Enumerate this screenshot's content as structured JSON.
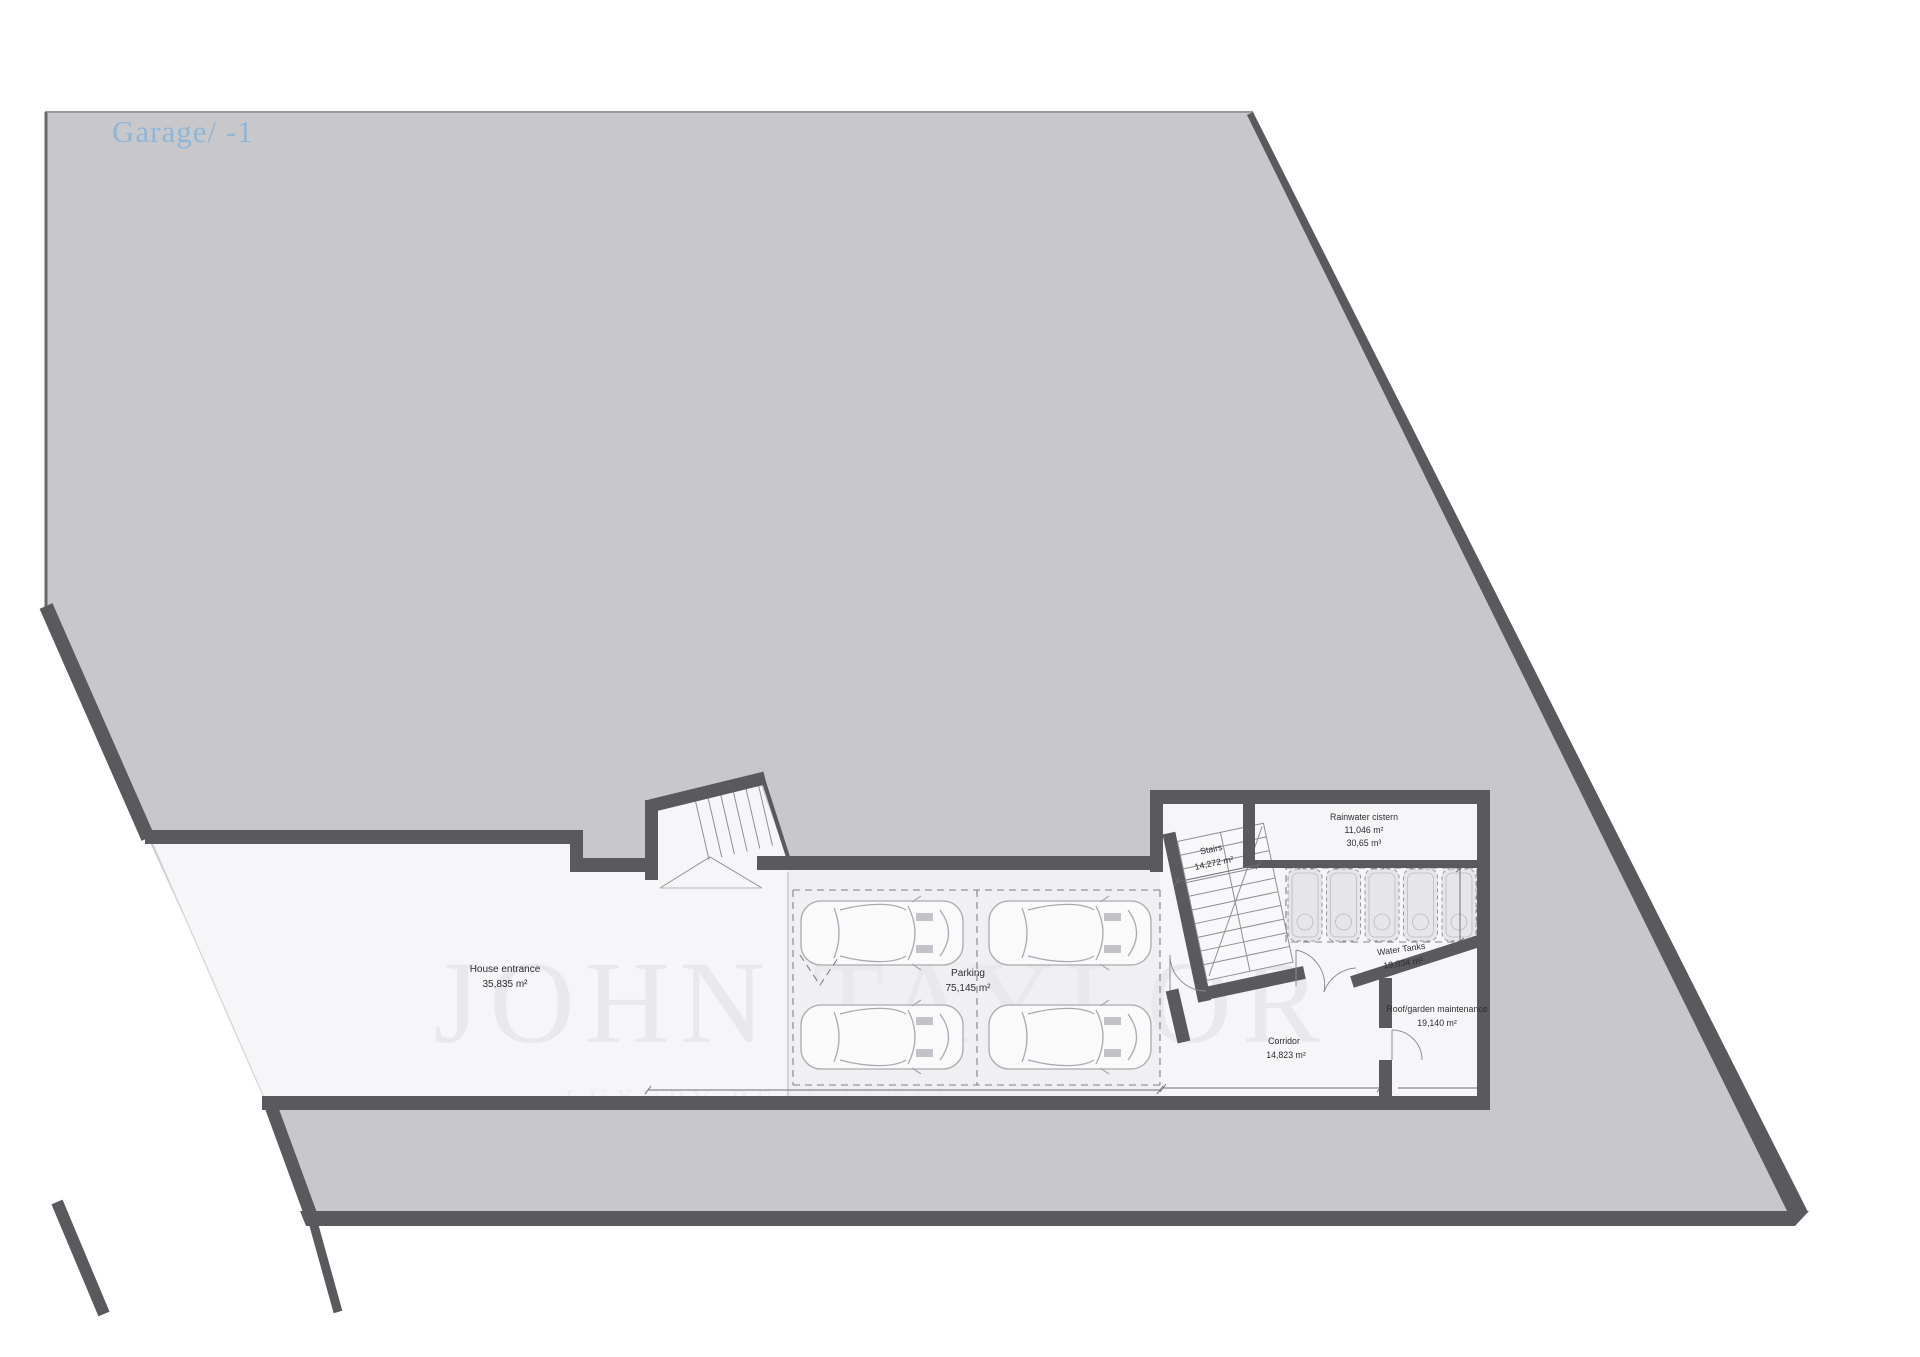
{
  "title": {
    "text": "Garage/ -1"
  },
  "watermark": {
    "line1": "JOHN TAYLOR",
    "line2": "LUXURY REAL ESTATE"
  },
  "rooms": {
    "house_entrance": {
      "name": "House entrance",
      "area": "35,835 m²"
    },
    "parking": {
      "name": "Parking",
      "area": "75,145 m²"
    },
    "stairs": {
      "name": "Stairs",
      "area": "14,272 m²"
    },
    "rainwater_cistern": {
      "name": "Rainwater cistern",
      "area": "11,046 m²",
      "volume": "30,65 m³"
    },
    "water_tanks": {
      "name": "Water Tanks",
      "area": "19,034 m²"
    },
    "roof_garden_maintenance": {
      "name": "Roof/garden maintenance",
      "area": "19,140 m²"
    },
    "corridor": {
      "name": "Corridor",
      "area": "14,823 m²"
    }
  },
  "colors": {
    "site": "#c8c8ca",
    "wall": "#5a5a5e",
    "floor": "#f6f6f8",
    "parking_floor": "#f0f0f3",
    "title": "#8fb6d9",
    "label": "#2e2e30",
    "watermark": "#e9e9ec"
  }
}
